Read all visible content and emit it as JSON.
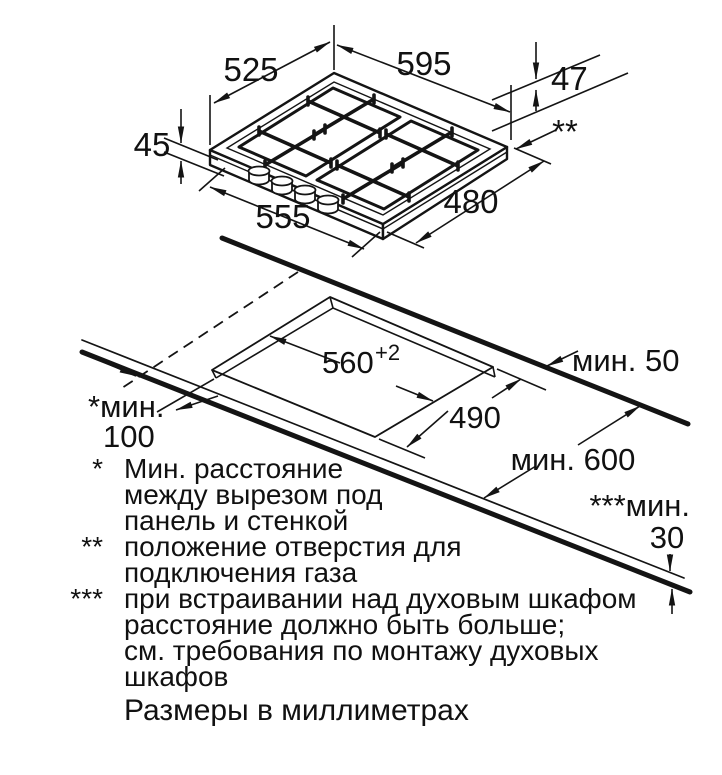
{
  "hob": {
    "dim_depth_top": "525",
    "dim_width_top": "595",
    "dim_gas_drop": "47",
    "dim_height": "45",
    "dim_width_bottom": "555",
    "dim_depth_bottom": "480",
    "gas_marker": "**"
  },
  "cutout": {
    "dim_width": "560",
    "dim_width_tolerance": "+2",
    "dim_depth": "490",
    "min_rear_clearance": "мин. 50",
    "min_side_label": "*мин.",
    "min_side_value": "100",
    "min_worktop_depth": "мин. 600",
    "min_oven_label": "***мин.",
    "min_oven_value": "30"
  },
  "footnotes": {
    "marker1": "*",
    "marker2": "**",
    "marker3": "***",
    "line1": "Мин. расстояние",
    "line2": "между вырезом под",
    "line3": "панель и стенкой",
    "line4": "положение отверстия для",
    "line5": "подключения газа",
    "line6": "при встраивании над духовым шкафом",
    "line7": "расстояние должно быть больше;",
    "line8": "см. требования по монтажу духовых",
    "line9": "шкафов",
    "units": "Размеры в миллиметрах"
  },
  "colors": {
    "ink": "#141414",
    "background": "#ffffff"
  }
}
